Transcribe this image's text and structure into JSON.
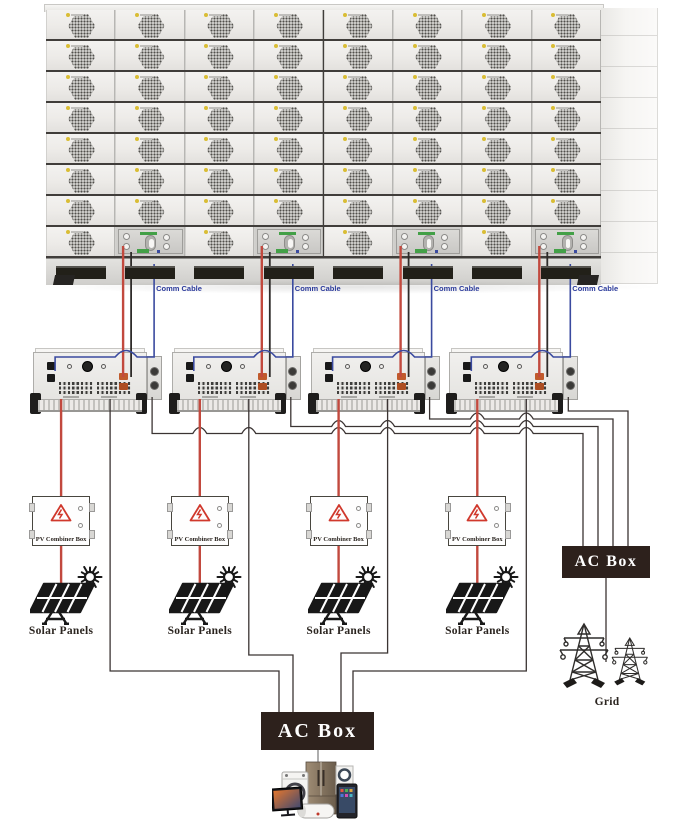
{
  "rack": {
    "rows": 8,
    "columns": 8,
    "control_unit_columns": [
      2,
      4,
      6,
      8
    ],
    "comm_cables": [
      {
        "label": "Comm Cable"
      },
      {
        "label": "Comm Cable"
      },
      {
        "label": "Comm Cable"
      },
      {
        "label": "Comm Cable"
      }
    ]
  },
  "inverter_count": 4,
  "pv_combiner_boxes": [
    {
      "label": "PV Combiner Box"
    },
    {
      "label": "PV Combiner Box"
    },
    {
      "label": "PV Combiner Box"
    },
    {
      "label": "PV Combiner Box"
    }
  ],
  "solar_panels": [
    {
      "label": "Solar Panels"
    },
    {
      "label": "Solar Panels"
    },
    {
      "label": "Solar Panels"
    },
    {
      "label": "Solar Panels"
    }
  ],
  "grid_ac_box": {
    "label": "AC Box"
  },
  "load_ac_box": {
    "label": "AC Box"
  },
  "grid": {
    "label": "Grid"
  },
  "colors": {
    "comm_text": "#2b3a9b",
    "wire_red": "#c2493e",
    "wire_black": "#2e2b29",
    "wire_blue": "#3a4a9f",
    "wire_ac": "#3b3433",
    "wire_gray": "#9a9a9a",
    "ac_box_bg": "#2d211c",
    "warning_red": "#d0382c",
    "label_dark": "#2b2520",
    "logo_yellow": "#d9bd35",
    "unit_green": "#43a047",
    "icon_dark": "#181818"
  }
}
